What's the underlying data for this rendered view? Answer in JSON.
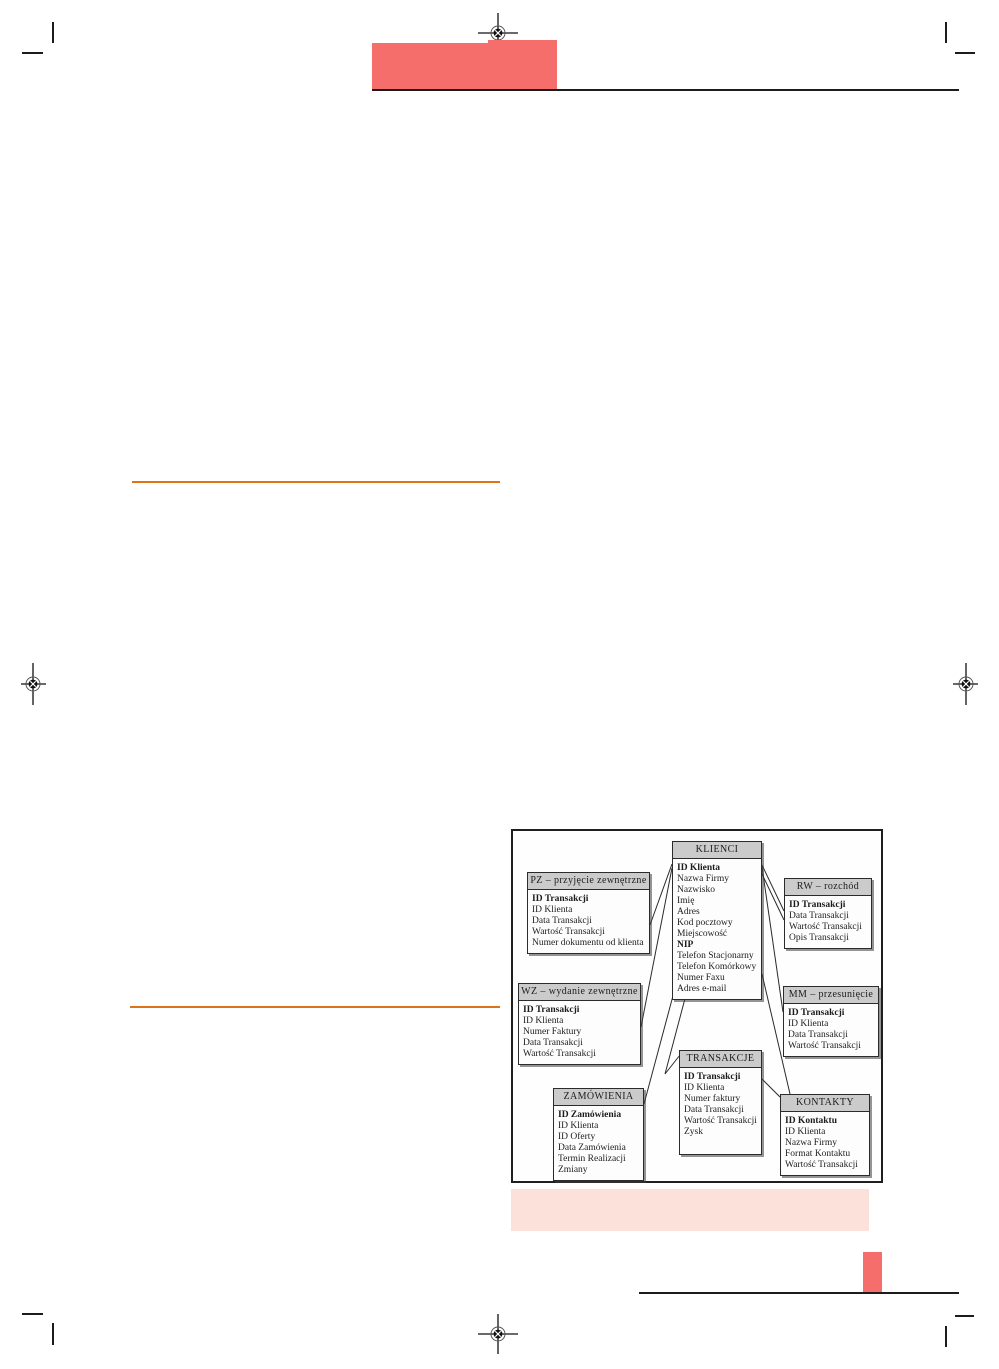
{
  "page": {
    "colors": {
      "accent_red": "#f56e6b",
      "accent_pink": "#fce1da",
      "accent_orange": "#dd7517",
      "ink": "#1c1c1c",
      "table_header_grey": "#cbcbcb"
    },
    "icons": {
      "registration_mark": "crosshair-in-circle print registration mark",
      "crop_mark": "corner crop tick"
    }
  },
  "diagram": {
    "tables": [
      {
        "key": "KLIENCI",
        "title": "KLIENCI",
        "fields": [
          {
            "label": "ID Klienta",
            "bold": true
          },
          {
            "label": "Nazwa Firmy",
            "bold": false
          },
          {
            "label": "Nazwisko",
            "bold": false
          },
          {
            "label": "Imię",
            "bold": false
          },
          {
            "label": "Adres",
            "bold": false
          },
          {
            "label": "Kod pocztowy",
            "bold": false
          },
          {
            "label": "Miejscowość",
            "bold": false
          },
          {
            "label": "NIP",
            "bold": true
          },
          {
            "label": "Telefon Stacjonarny",
            "bold": false
          },
          {
            "label": "Telefon Komórkowy",
            "bold": false
          },
          {
            "label": "Numer Faxu",
            "bold": false
          },
          {
            "label": "Adres e-mail",
            "bold": false
          }
        ]
      },
      {
        "key": "PZ",
        "title": "PZ – przyjęcie zewnętrzne",
        "fields": [
          {
            "label": "ID Transakcji",
            "bold": true
          },
          {
            "label": "ID Klienta",
            "bold": false
          },
          {
            "label": "Data Transakcji",
            "bold": false
          },
          {
            "label": "Wartość Transakcji",
            "bold": false
          },
          {
            "label": "Numer dokumentu od klienta",
            "bold": false
          }
        ]
      },
      {
        "key": "RW",
        "title": "RW – rozchód",
        "fields": [
          {
            "label": "ID Transakcji",
            "bold": true
          },
          {
            "label": "Data Transakcji",
            "bold": false
          },
          {
            "label": "Wartość Transakcji",
            "bold": false
          },
          {
            "label": "Opis Transakcji",
            "bold": false
          }
        ]
      },
      {
        "key": "WZ",
        "title": "WZ – wydanie zewnętrzne",
        "fields": [
          {
            "label": "ID Transakcji",
            "bold": true
          },
          {
            "label": "ID Klienta",
            "bold": false
          },
          {
            "label": "Numer Faktury",
            "bold": false
          },
          {
            "label": "Data Transakcji",
            "bold": false
          },
          {
            "label": "Wartość Transakcji",
            "bold": false
          }
        ]
      },
      {
        "key": "MM",
        "title": "MM – przesunięcie",
        "fields": [
          {
            "label": "ID Transakcji",
            "bold": true
          },
          {
            "label": "ID Klienta",
            "bold": false
          },
          {
            "label": "Data Transakcji",
            "bold": false
          },
          {
            "label": "Wartość Transakcji",
            "bold": false
          }
        ]
      },
      {
        "key": "TRANSAKCJE",
        "title": "TRANSAKCJE",
        "fields": [
          {
            "label": "ID Transakcji",
            "bold": true
          },
          {
            "label": "ID Klienta",
            "bold": false
          },
          {
            "label": "Numer faktury",
            "bold": false
          },
          {
            "label": "Data Transakcji",
            "bold": false
          },
          {
            "label": "Wartość Transakcji",
            "bold": false
          },
          {
            "label": "Zysk",
            "bold": false
          }
        ]
      },
      {
        "key": "ZAMOWIENIA",
        "title": "ZAMÓWIENIA",
        "fields": [
          {
            "label": "ID Zamówienia",
            "bold": true
          },
          {
            "label": "ID Klienta",
            "bold": false
          },
          {
            "label": "ID Oferty",
            "bold": false
          },
          {
            "label": "Data Zamówienia",
            "bold": false
          },
          {
            "label": "Termin Realizacji",
            "bold": false
          },
          {
            "label": "Zmiany",
            "bold": false
          }
        ]
      },
      {
        "key": "KONTAKTY",
        "title": "KONTAKTY",
        "fields": [
          {
            "label": "ID Kontaktu",
            "bold": true
          },
          {
            "label": "ID Klienta",
            "bold": false
          },
          {
            "label": "Nazwa Firmy",
            "bold": false
          },
          {
            "label": "Format Kontaktu",
            "bold": false
          },
          {
            "label": "Wartość Transakcji",
            "bold": false
          }
        ]
      }
    ],
    "relations": [
      {
        "from": "KLIENCI",
        "to": "PZ"
      },
      {
        "from": "KLIENCI",
        "to": "WZ"
      },
      {
        "from": "KLIENCI",
        "to": "ZAMOWIENIA"
      },
      {
        "from": "KLIENCI",
        "to": "TRANSAKCJE"
      },
      {
        "from": "KLIENCI",
        "to": "RW"
      },
      {
        "from": "KLIENCI",
        "to": "MM"
      },
      {
        "from": "KLIENCI",
        "to": "KONTAKTY"
      },
      {
        "from": "TRANSAKCJE",
        "to": "KONTAKTY"
      }
    ]
  }
}
